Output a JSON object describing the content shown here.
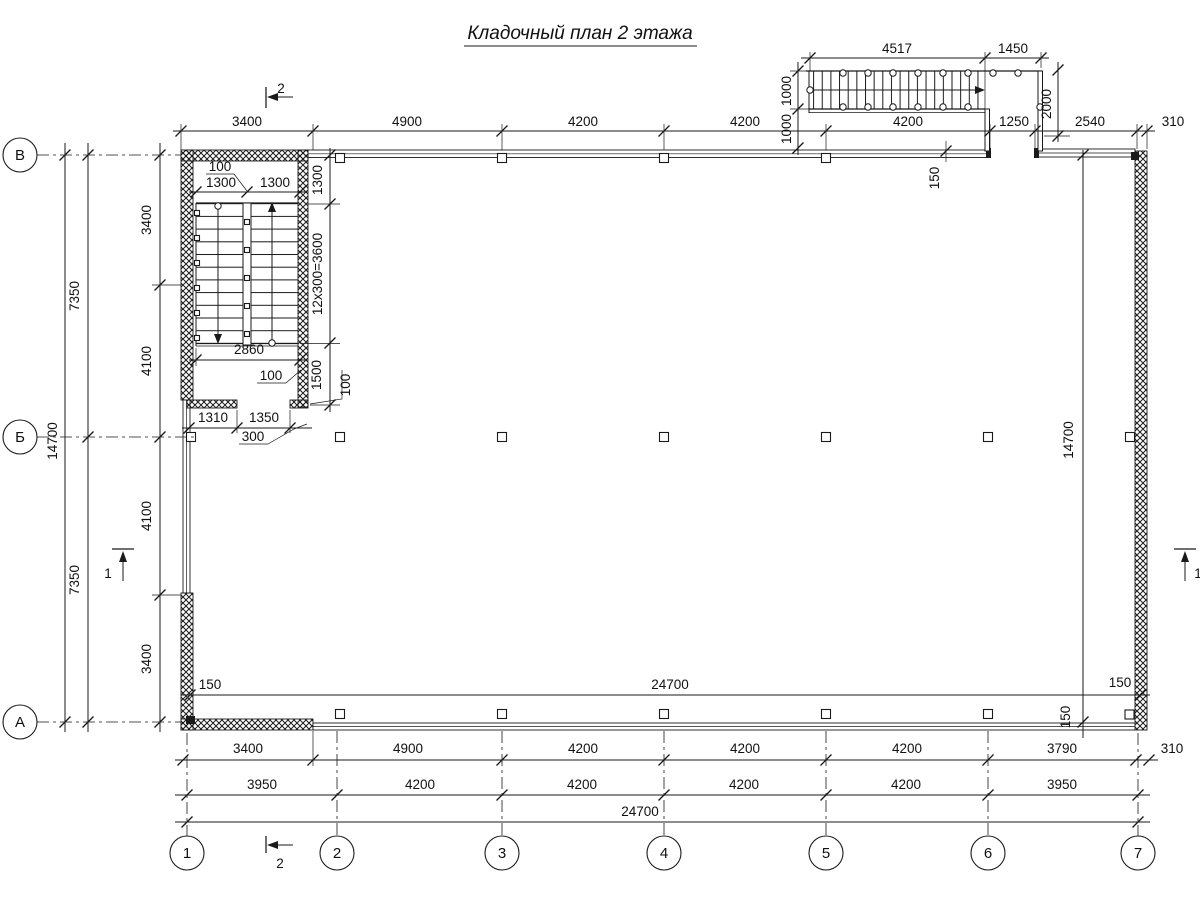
{
  "title": "Кладочный план 2 этажа",
  "axes": {
    "cols": [
      "1",
      "2",
      "3",
      "4",
      "5",
      "6",
      "7"
    ],
    "rows": [
      "В",
      "Б",
      "А"
    ]
  },
  "markers": {
    "sec2": "2",
    "sec1": "1"
  },
  "dims": {
    "top_row": [
      "3400",
      "4900",
      "4200",
      "4200",
      "4200",
      "1250",
      "2540",
      "310"
    ],
    "ext_top": [
      "4517",
      "1450"
    ],
    "ext_left": [
      "1000",
      "1000"
    ],
    "ext_right": "2000",
    "wall_off_top": "150",
    "left_total": "14700",
    "left_halves": [
      "7350",
      "7350"
    ],
    "left_inner": [
      "3400",
      "4100",
      "4100",
      "3400"
    ],
    "int_width": "24700",
    "int_off_left": "150",
    "int_off_right": "150",
    "int_off_bottom": "150",
    "right_total": "14700",
    "row1": [
      "3400",
      "4900",
      "4200",
      "4200",
      "4200",
      "3790",
      "310"
    ],
    "row2": [
      "3950",
      "4200",
      "4200",
      "4200",
      "4200",
      "3950"
    ],
    "total": "24700",
    "st_top_leader": "100",
    "st_top": [
      "1300",
      "1300"
    ],
    "st_landing": "1300",
    "st_run": "12x300=3600",
    "st_bottom_landing": "1500",
    "st_right_leader": "100",
    "st_width": "2860",
    "st_wall_leader": "100",
    "st_door": [
      "1310",
      "1350"
    ],
    "st_door_leader": "300"
  }
}
